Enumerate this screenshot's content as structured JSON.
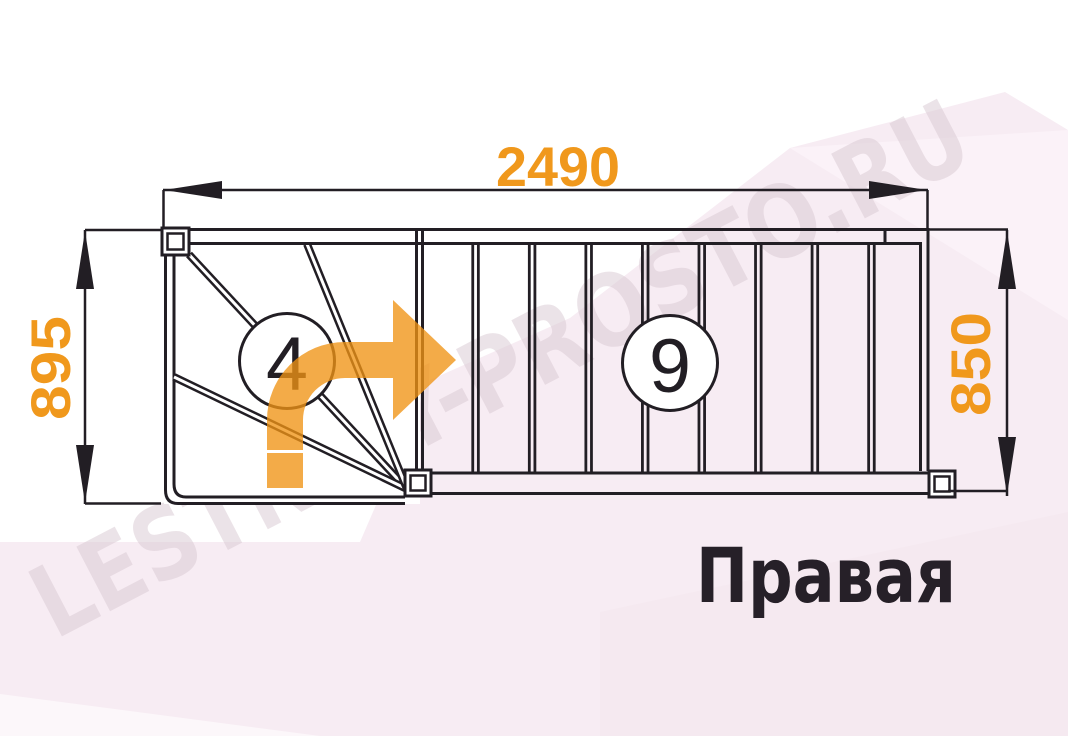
{
  "diagram_title": "Правая",
  "watermark_text": "LESTNICY-PROSTO.RU",
  "dimensions": {
    "total_length_mm": "2490",
    "entry_width_mm": "895",
    "flight_width_mm": "850"
  },
  "steps": {
    "winder_steps": "4",
    "straight_steps": "9"
  },
  "colors": {
    "dimension_orange": "#f0981c",
    "direction_arrow_orange": "#ef9415",
    "line_color": "#221e24",
    "background_pink": "#f7ecf3",
    "watermark_gray": "#d9c9d2",
    "title_color": "#262028"
  }
}
